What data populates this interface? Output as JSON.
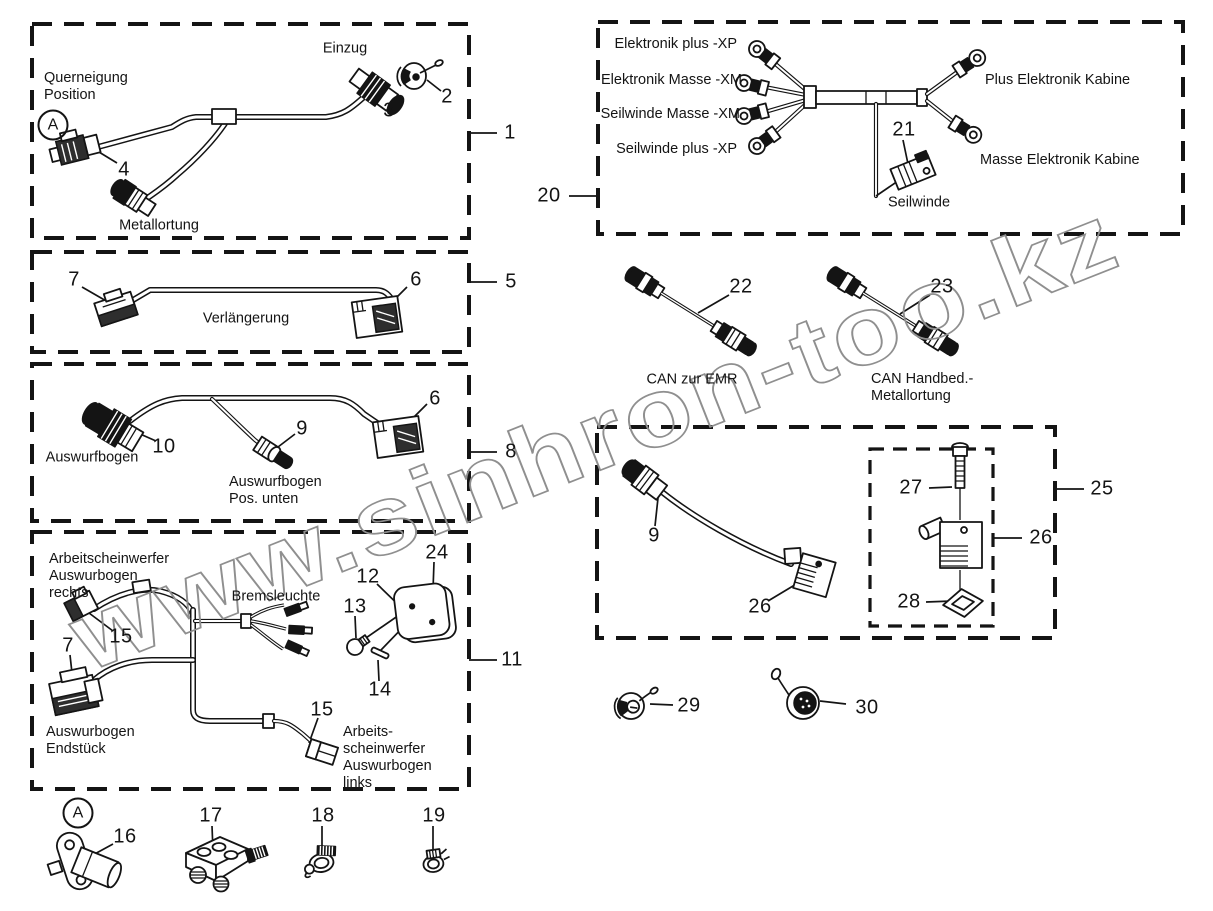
{
  "watermark": "www.sinhron-too.kz",
  "box1": {
    "ref": "1",
    "p2": "2",
    "p3": "3",
    "p4": "4",
    "einzug": "Einzug",
    "querneigung": "Querneigung\nPosition",
    "marker_a": "A",
    "metallortung": "Metallortung"
  },
  "box5": {
    "ref": "5",
    "p6": "6",
    "p7": "7",
    "verlaengerung": "Verlängerung"
  },
  "box8": {
    "ref": "8",
    "p6": "6",
    "p9": "9",
    "p10": "10",
    "auswurfbogen": "Auswurfbogen",
    "auswurfbogen_pos": "Auswurfbogen\nPos. unten"
  },
  "box11": {
    "ref": "11",
    "p7": "7",
    "p12": "12",
    "p13": "13",
    "p14": "14",
    "p15_oben": "15",
    "p15_unten": "15",
    "p24": "24",
    "scheinwerfer_rechts": "Arbeitscheinwerfer\nAuswurbogen\nrechts",
    "bremsleuchte": "Bremsleuchte",
    "endstueck": "Auswurbogen\nEndstück",
    "scheinwerfer_links": "Arbeits-\nscheinwerfer\nAuswurbogen\nlinks"
  },
  "box20": {
    "ref": "20",
    "p21": "21",
    "elektronik_plus": "Elektronik plus -XP",
    "elektronik_masse": "Elektronik Masse -XM",
    "seilwinde_masse": "Seilwinde Masse -XM",
    "seilwinde_plus": "Seilwinde plus -XP",
    "plus_kabine": "Plus Elektronik Kabine",
    "masse_kabine": "Masse Elektronik Kabine",
    "seilwinde": "Seilwinde"
  },
  "can": {
    "p22": "22",
    "p23": "23",
    "zur_emr": "CAN zur EMR",
    "handbed": "CAN Handbed.-\nMetallortung"
  },
  "box25": {
    "ref": "25",
    "p9": "9",
    "p26_links": "26",
    "p26_rechts": "26",
    "p27": "27",
    "p28": "28"
  },
  "parts": {
    "p29": "29",
    "p30": "30",
    "marker_a": "A",
    "p16": "16",
    "p17": "17",
    "p18": "18",
    "p19": "19"
  }
}
